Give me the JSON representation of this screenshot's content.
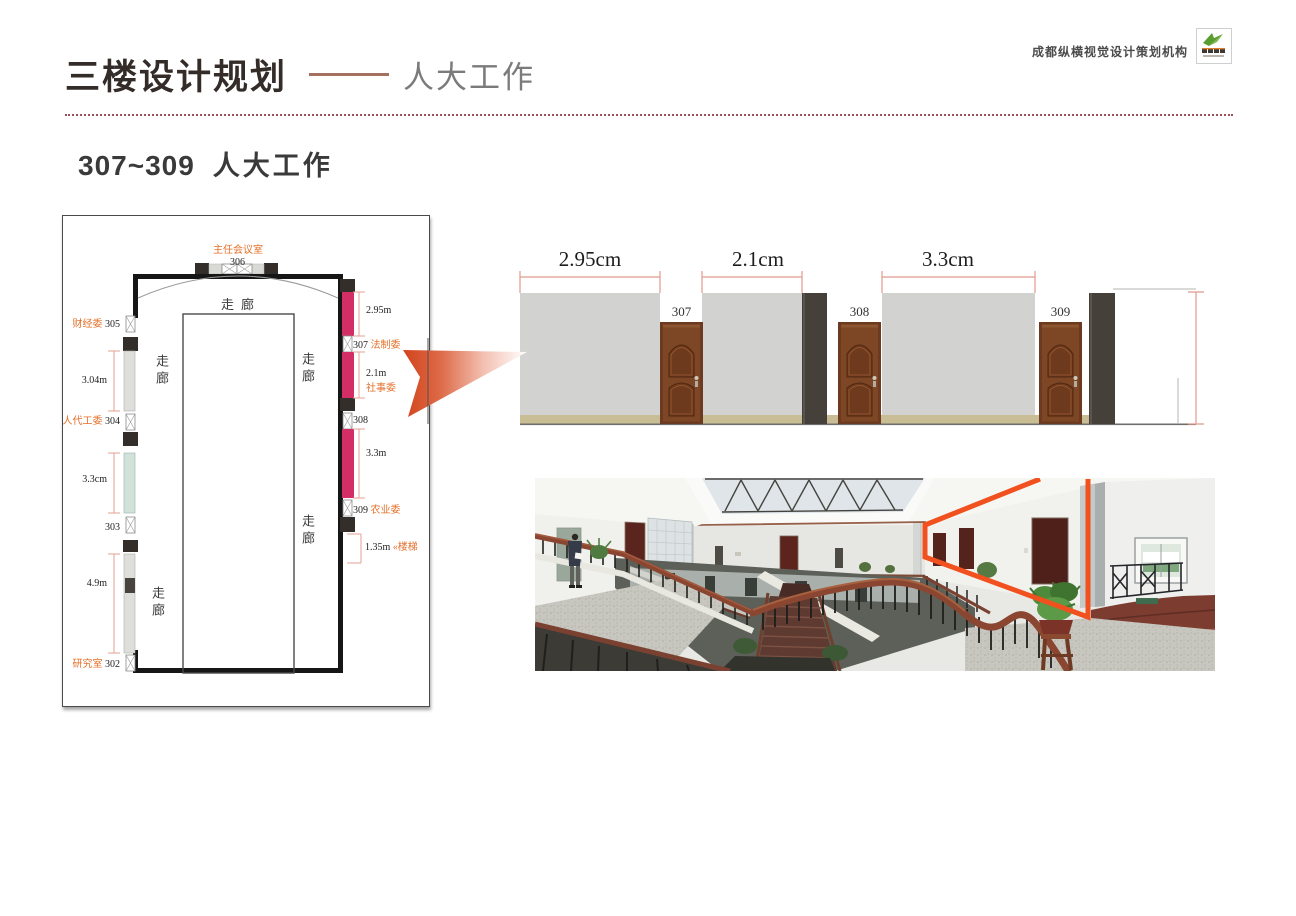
{
  "header": {
    "title": "三楼设计规划",
    "subtitle": "人大工作",
    "agency_name": "成都纵横视觉设计策划机构",
    "section_code": "307~309",
    "section_name": "人大工作"
  },
  "plan": {
    "corridor": "走廊",
    "room_306_name": "主任会议室",
    "room_306_num": "306",
    "room_305_name": "财经委",
    "room_305_num": "305",
    "dim_left_1": "3.04m",
    "room_304_name": "人代工委",
    "room_304_num": "304",
    "dim_left_2": "3.3cm",
    "room_303_num": "303",
    "dim_left_3": "4.9m",
    "room_302_name": "研究室",
    "room_302_num": "302",
    "dim_right_1": "2.95m",
    "room_307_num": "307",
    "room_307_name": "法制委",
    "dim_right_2": "2.1m",
    "label_social": "社事委",
    "room_308_num": "308",
    "dim_right_3": "3.3m",
    "room_309_num": "309",
    "room_309_name": "农业委",
    "dim_right_4": "1.35m",
    "label_stairs": "«楼梯"
  },
  "elevation": {
    "dim_1": "2.95cm",
    "dim_2": "2.1cm",
    "dim_3": "3.3cm",
    "door_1": "307",
    "door_2": "308",
    "door_3": "309"
  },
  "colors": {
    "accent_orange": "#e4702a",
    "highlight_pink": "#d42e66",
    "arrow_red": "#d2431c",
    "photo_outline_orange": "#f1501f",
    "dimension_line": "#e09a8e",
    "divider_maroon": "#9c4f5a",
    "dash_brown": "#a5705f"
  }
}
